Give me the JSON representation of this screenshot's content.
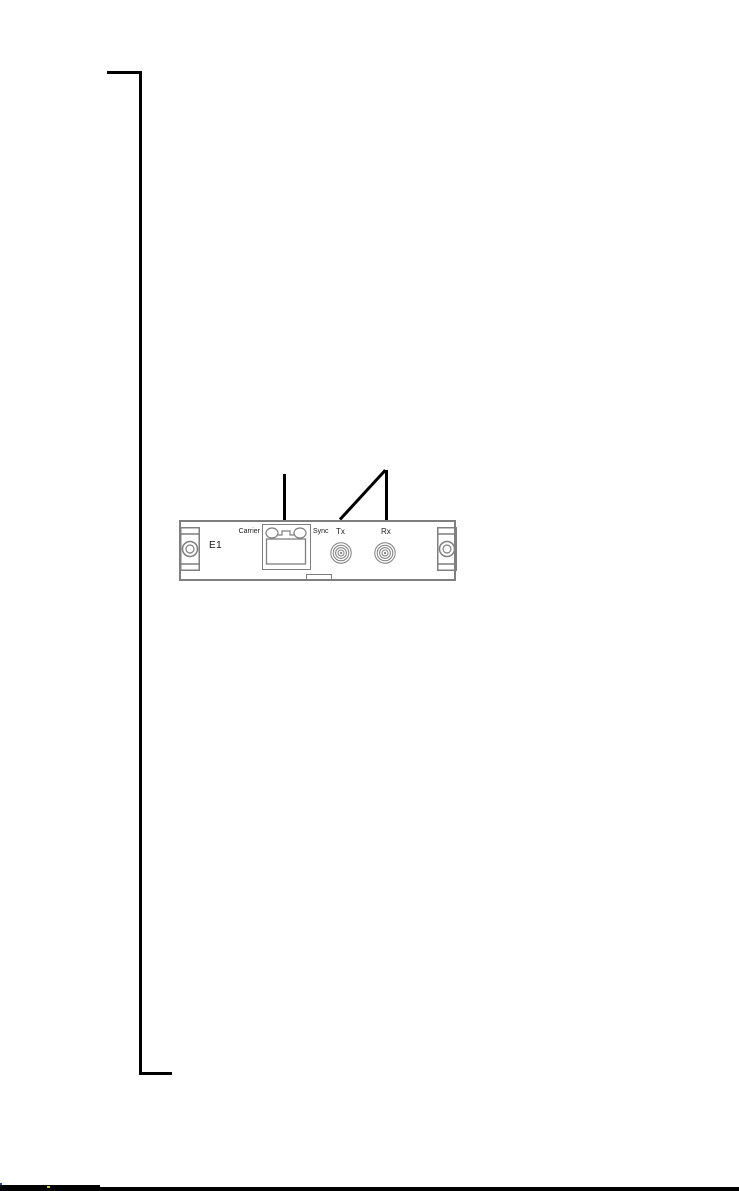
{
  "colors": {
    "page-bg": "#ffffff",
    "margin-line": "#000000",
    "callout": "#000000",
    "panel-stroke": "#7f7f7f",
    "footer-bar": "#000000",
    "artifact-yellow": "#c8c832",
    "artifact-blue": "#334499"
  },
  "figure": {
    "panel": {
      "label": "E1",
      "rj45": {
        "left_led_label": "Carrier",
        "right_led_label": "Sync"
      },
      "connectors": [
        {
          "label": "Tx"
        },
        {
          "label": "Rx"
        }
      ]
    }
  }
}
